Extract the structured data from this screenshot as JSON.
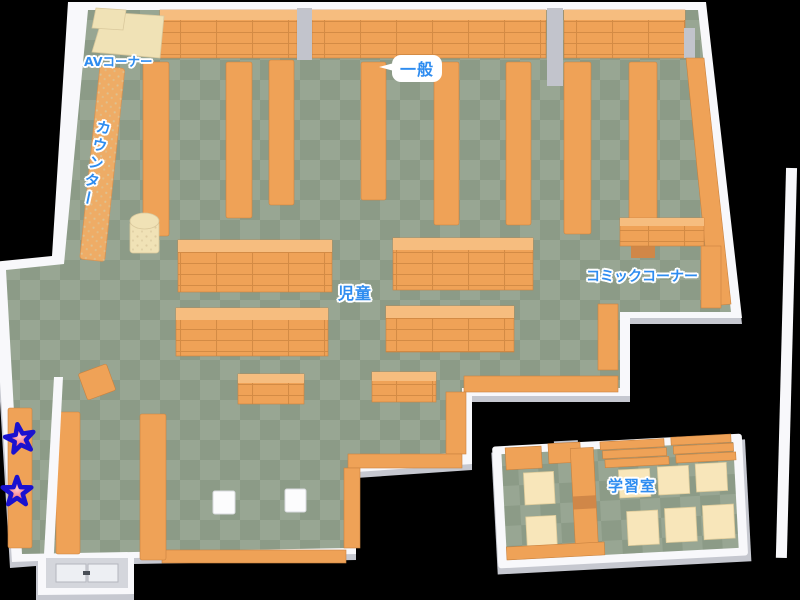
{
  "map": {
    "name": "library-floor-map",
    "areas": {
      "av_corner": "AVコーナー",
      "general": "一般",
      "counter": "カウンター",
      "children": "児童",
      "comic_corner": "コミックコーナー",
      "study_room": "学習室"
    },
    "markers": {
      "star_count": 2
    }
  },
  "colors": {
    "floor_light": "#98a693",
    "floor_dark": "#8c9b87",
    "wall": "#f8f8fb",
    "wall_shadow": "#c6c8d0",
    "shelf": "#efa257",
    "shelf_top": "#f6bd7f",
    "shelf_dark": "#d08748",
    "shelf_line": "#c9823f",
    "pillar": "#c2c4cc",
    "cream": "#f0e2b6",
    "table": "#f8e6ba",
    "counter": "#eeac66",
    "label_blue": "#2e8cf0",
    "star_fill": "#f4606e",
    "star_stroke": "#1a11cf"
  }
}
